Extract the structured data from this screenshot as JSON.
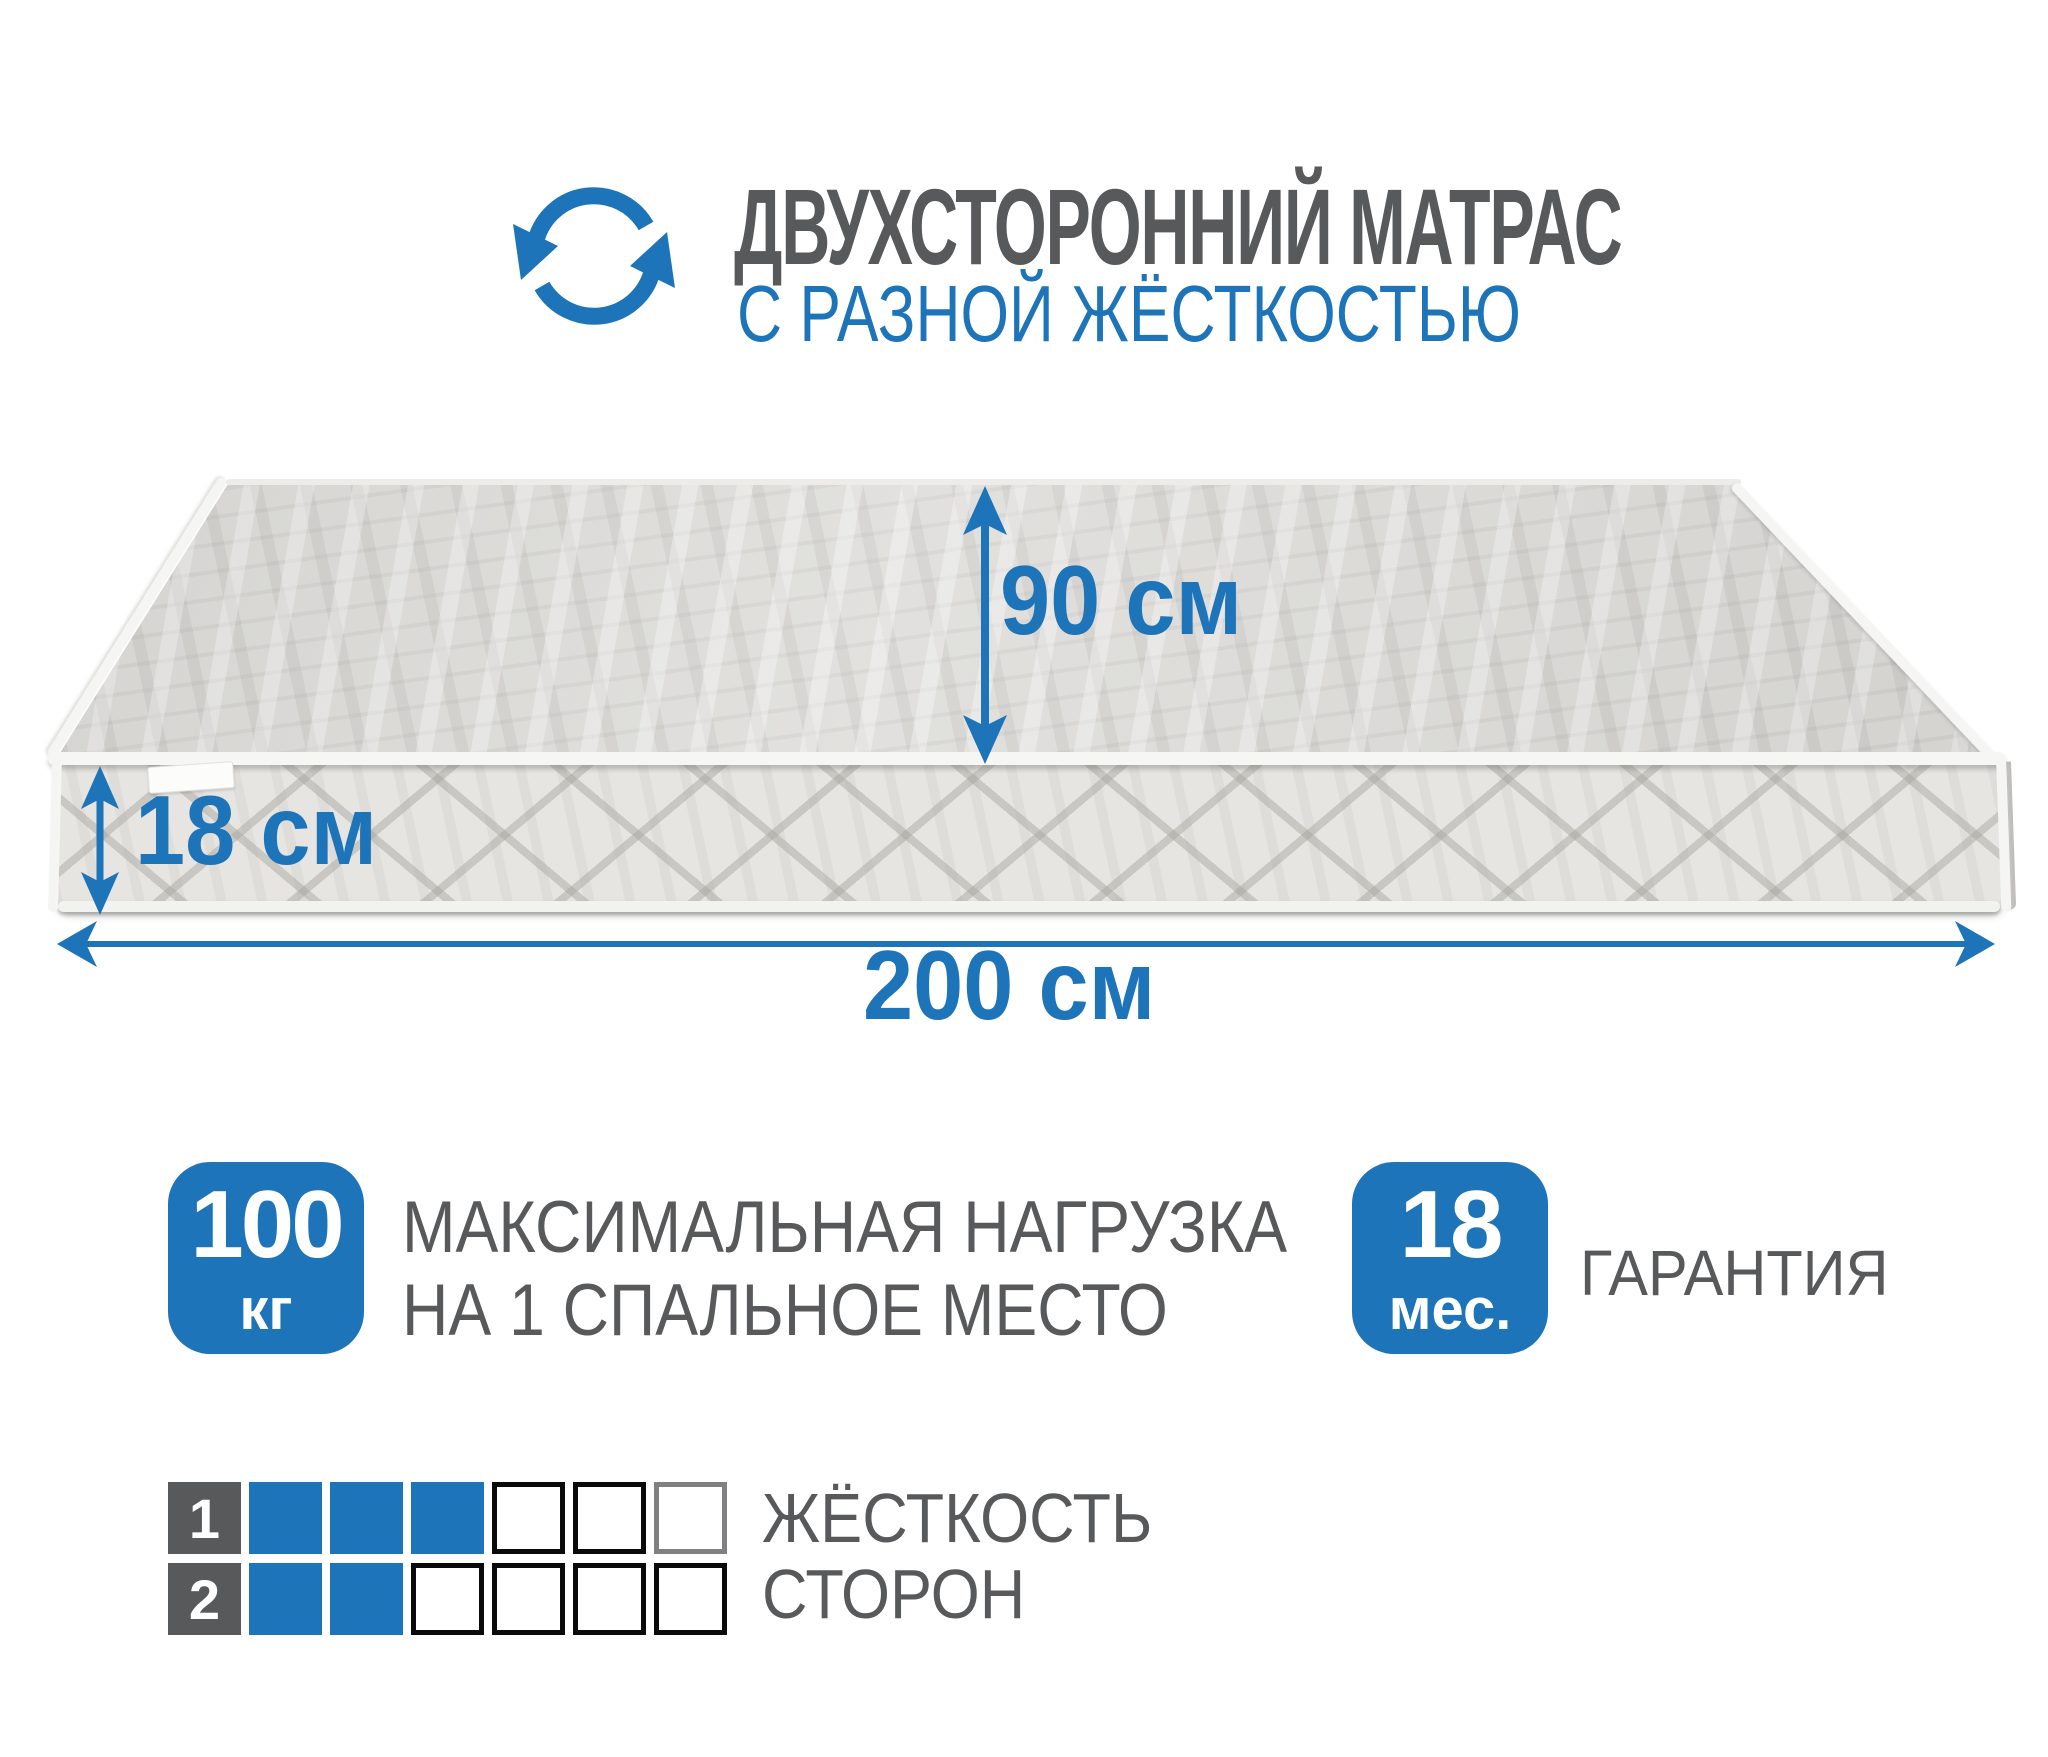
{
  "header": {
    "title": "ДВУХСТОРОННИЙ МАТРАС",
    "subtitle": "С РАЗНОЙ ЖЁСТКОСТЬЮ",
    "icon": "rotate-arrows-icon"
  },
  "dimensions": {
    "width_label": "90 см",
    "thickness_label": "18 см",
    "length_label": "200 см"
  },
  "features": {
    "max_load": {
      "value": "100",
      "unit": "кг",
      "description_line1": "МАКСИМАЛЬНАЯ НАГРУЗКА",
      "description_line2": "НА 1 СПАЛЬНОЕ МЕСТО"
    },
    "warranty": {
      "value": "18",
      "unit": "мес.",
      "label": "ГАРАНТИЯ"
    }
  },
  "firmness": {
    "caption_line1": "ЖЁСТКОСТЬ",
    "caption_line2": "СТОРОН",
    "rows": [
      {
        "side": "1",
        "filled": 3,
        "total": 6
      },
      {
        "side": "2",
        "filled": 2,
        "total": 6
      }
    ]
  },
  "colors": {
    "accent_blue": "#1d74b9",
    "text_gray": "#58595b"
  }
}
